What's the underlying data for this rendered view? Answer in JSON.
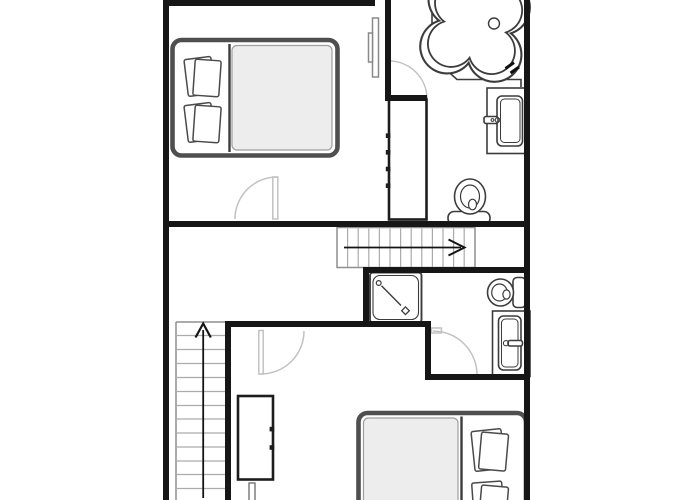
{
  "plan": {
    "kind": "floor-plan",
    "description-icon": "two-level-house-floor-plan",
    "levels": [
      "upper-level-with-bedroom-and-bathroom",
      "lower-level-with-bedroom-bathroom-and-stairs"
    ]
  },
  "labels": {
    "plan": "apartment floor plan",
    "bed1": "double-bed-with-two-pillows",
    "bed2": "double-bed-with-two-pillows",
    "wardrobe1": "wardrobe-cabinet",
    "wardrobe2": "wardrobe-cabinet",
    "tub": "corner-bathtub",
    "tub_deck": "bathtub-corner-deck",
    "sink1": "washbasin-vanity",
    "sink2": "washbasin-vanity",
    "toilet1": "toilet",
    "toilet2": "toilet",
    "shower": "shower-stall",
    "stairs_mid": "staircase-run-arrow-right",
    "stairs_left": "staircase-run-arrow-up",
    "door_bedroom1": "door-swing",
    "door_bath1": "door-swing",
    "door_bedroom2": "door-swing",
    "door_bath2": "door-swing",
    "sliding_door": "sliding-pocket-door-panels",
    "walls": "structural-walls"
  },
  "colors": {
    "background": "#ffffff",
    "wall": "#161616",
    "fixture": "#3c3c3c",
    "door": "#c2c2c2",
    "stair_border": "#8f8f8f",
    "stair_tread": "#ababab",
    "arrow": "#141414",
    "bed_frame": "#4f4f4f",
    "bedding": "#ededed",
    "bedding_edge": "#9e9e9e",
    "cabinet": "#1d1d1d",
    "pillow": "#4a4a4a"
  }
}
